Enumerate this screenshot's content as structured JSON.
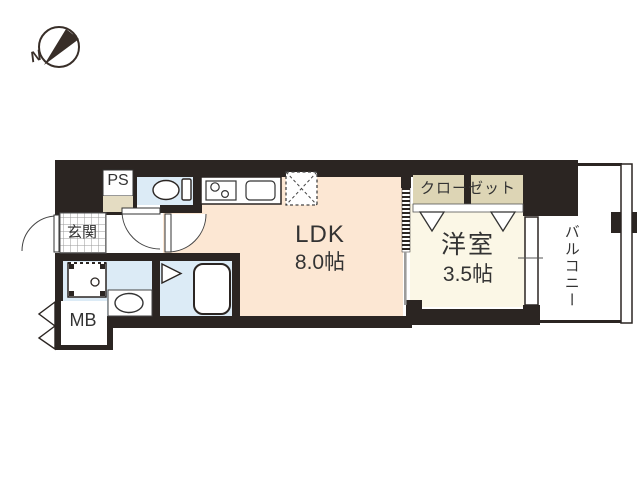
{
  "compass": {
    "north_label": "N",
    "icon": "compass-north-icon"
  },
  "rooms": {
    "ps": {
      "label": "PS"
    },
    "genkan": {
      "label": "玄関"
    },
    "ldk": {
      "label": "LDK",
      "size": "8.0帖"
    },
    "closet": {
      "label": "クローゼット"
    },
    "western_room": {
      "label": "洋室",
      "size": "3.5帖"
    },
    "balcony": {
      "label": "バルコニー"
    },
    "meter_box": {
      "label": "MB"
    }
  },
  "fixtures": [
    "toilet-icon",
    "kitchen-stove-icon",
    "kitchen-sink-icon",
    "refrigerator-space-icon",
    "washing-machine-icon",
    "wash-basin-icon",
    "bathtub-icon",
    "folding-door-icon",
    "closet-door-icon",
    "door-swing-icon",
    "window-icon",
    "balcony-railing-icon"
  ],
  "colors": {
    "wall": "#2b2522",
    "ldk_floor": "#fce7d3",
    "western_room_floor": "#fbf7e6",
    "closet_floor": "#ddd5b5",
    "wet_area_floor": "#dcebf6",
    "ps_floor": "#e4dcc2",
    "text": "#333333"
  }
}
